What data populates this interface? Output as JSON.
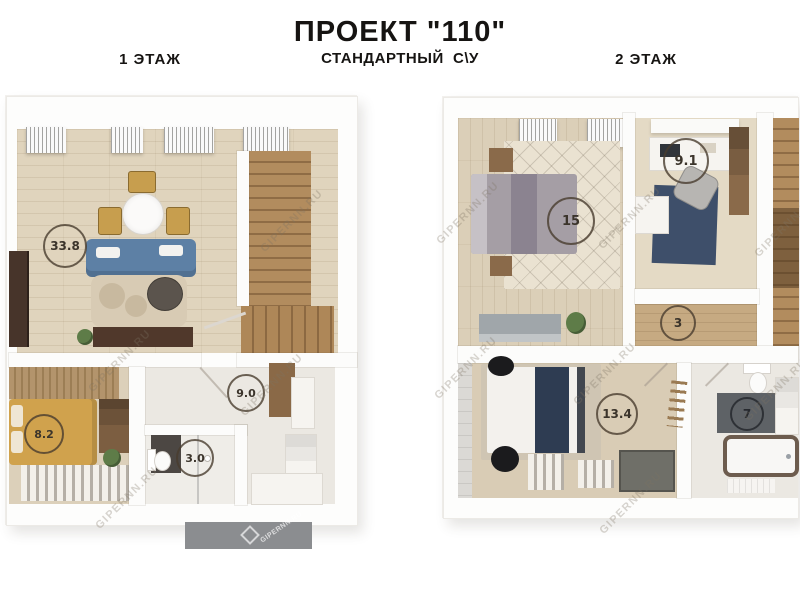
{
  "header": {
    "title": "ПРОЕКТ \"110\"",
    "subtitle": "СТАНДАРТНЫЙ  С\\У"
  },
  "floors": [
    {
      "label": "1 ЭТАЖ",
      "rooms": [
        {
          "id": "living-kitchen",
          "area": "33.8"
        },
        {
          "id": "hall",
          "area": "9.0"
        },
        {
          "id": "bedroom",
          "area": "8.2"
        },
        {
          "id": "bathroom",
          "area": "3.0"
        }
      ]
    },
    {
      "label": "2 ЭТАЖ",
      "rooms": [
        {
          "id": "bedroom-1",
          "area": "15"
        },
        {
          "id": "office",
          "area": "9.1"
        },
        {
          "id": "hall",
          "area": "3"
        },
        {
          "id": "bedroom-2",
          "area": "13.4"
        },
        {
          "id": "bathroom",
          "area": "7"
        }
      ]
    }
  ],
  "watermark": {
    "text": "GIPERNN.RU"
  },
  "colors": {
    "wood_floor": "#e0d4bd",
    "stairs": "#b28c5e",
    "sofa_blue": "#5d80a5",
    "bed_yellow": "#d0a24d",
    "rug_navy": "#3e4f6a",
    "runner_navy": "#2e3c52",
    "porch_gray": "#8b8d90"
  }
}
